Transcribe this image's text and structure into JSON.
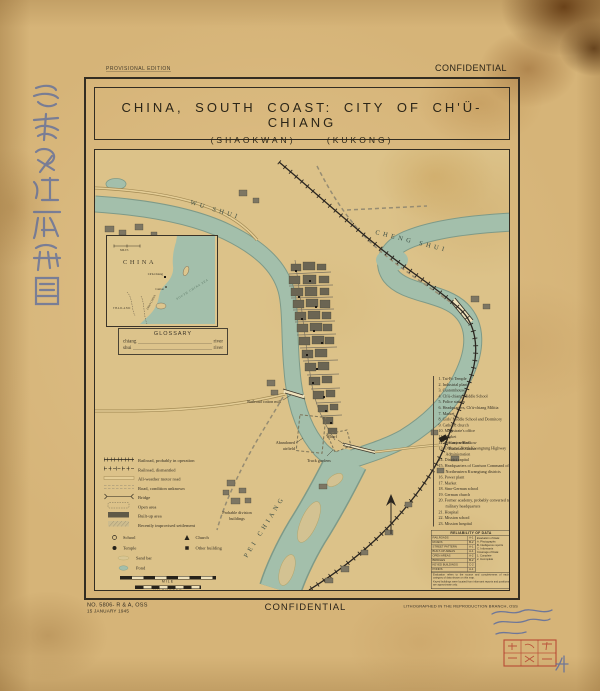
{
  "sheet": {
    "edition": "PROVISIONAL EDITION",
    "confidential_top": "CONFIDENTIAL",
    "confidential_bottom": "CONFIDENTIAL",
    "map_no": "NO. 5806- R & A, OSS",
    "map_date": "15 JANUARY 1945",
    "litho_credit": "LITHOGRAPHED IN THE REPRODUCTION BRANCH, OSS"
  },
  "title": {
    "line1": "CHINA, SOUTH COAST: CITY OF CH'Ü-CHIANG",
    "alt1": "(SHAOKWAN)",
    "alt2": "(KUKONG)"
  },
  "inset_map": {
    "country": "CHINA",
    "city": "Ch'ü-Chiang",
    "canton": "Canton",
    "thailand": "THAILAND",
    "indochina": "INDO-CHINA",
    "sea": "SOUTH CHINA SEA",
    "scale_label": "MILES"
  },
  "glossary": {
    "title": "GLOSSARY",
    "entries": [
      {
        "term": "chiang",
        "def": "river"
      },
      {
        "term": "shui",
        "def": "river"
      }
    ]
  },
  "map_labels": {
    "wu_shui": "WU SHUI",
    "cheng_shui": "CHENG SHUI",
    "pei_chiang": "PEI CHIANG",
    "cotton_mill": "Railroad cotton mill",
    "airfield_1": "Abandoned",
    "airfield_2": "airfield",
    "truck_gardens": "Truck gardens",
    "wharf": "Wharf",
    "station_1": "Canton-Hankow",
    "station_2": "Railroad Station",
    "division_1": "Probable division",
    "division_2": "buildings"
  },
  "legend": {
    "line_items": [
      "Railroad, probably in operation",
      "Railroad, dismantled",
      "All-weather motor road",
      "Road, condition unknown",
      "Bridge",
      "Open area",
      "Built-up area",
      "Recently improvised settlement"
    ],
    "point_items": [
      "School",
      "Church",
      "Temple",
      "Other building"
    ],
    "sand_bar": "Sand bar",
    "pond": "Pond",
    "scale_mile": "MILE",
    "scale_km": "KILOMETER"
  },
  "key_list": {
    "items": [
      "1. Tai-Fo Temple",
      "2. Industrial plant",
      "3. Customhouse",
      "4. Ch'ü-chiang Middle School",
      "5. Police station",
      "6. Headquarters, Ch'ü-chiang Militia",
      "7. Market",
      "8. Girls' Middle School and Dormitory",
      "9. Catholic church",
      "10. Magistrate's office",
      "11. Market",
      "12. Primary school",
      "13. Office of North Kwangtung Highway Administration",
      "14. District capital",
      "15. Headquarters of Garrison Command of Northeastern Kwangtung districts",
      "16. Power plant",
      "17. Market",
      "18. Sino-German school",
      "19. German church",
      "20. Former academy, probably converted to military headquarters",
      "21. Hospital",
      "22. Mission school",
      "23. Mission hospital"
    ]
  },
  "reliability": {
    "title": "RELIABILITY OF DATA",
    "rows": [
      {
        "name": "RAILROADS",
        "grade": "A-1"
      },
      {
        "name": "ROADS",
        "grade": "B-2"
      },
      {
        "name": "STREET PATTERN",
        "grade": "A-1"
      },
      {
        "name": "BUILT-UP AREAS",
        "grade": "A-1"
      },
      {
        "name": "OPEN AREAS",
        "grade": "A-2"
      },
      {
        "name": "BRIDGES",
        "grade": "B-2"
      },
      {
        "name": "KEYED BUILDINGS",
        "grade": "C-2"
      },
      {
        "name": "PONDS",
        "grade": "A-1"
      }
    ],
    "legend_header": "Evaluation of Data:",
    "legend_lines": [
      "A. Photographs",
      "B. Intelligence reports",
      "C. Informants",
      "Coverage of Data:",
      "1. Complete",
      "2. Incomplete"
    ],
    "notes": [
      "Evaluation refers to the source and completeness of each category of data shown on this map.",
      "Keyed buildings were located from informant reports and positions are approximate only."
    ]
  },
  "colors": {
    "river": "#a3bfab",
    "paper": "#d6b478",
    "ink": "#2e2a20",
    "blue_ink": "#5568a0",
    "red_stamp": "#b43a2a"
  }
}
